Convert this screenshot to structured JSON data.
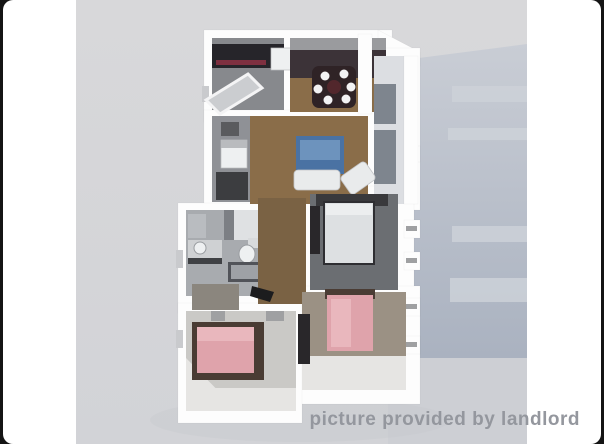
{
  "watermark": {
    "text": "picture provided by landlord"
  },
  "scene": {
    "description": "3D rendered top-down floor plan of a two-bedroom-plus-den apartment on a gray studio background"
  },
  "colors": {
    "frame_bg": "#141414",
    "card_bg": "#ffffff",
    "photo_top": "#d8d8da",
    "photo_bottom": "#d2d3d7",
    "shadow_top": "#c9cdd5",
    "shadow_bottom": "#aab2c0",
    "shadow_band": "#cdd1d8",
    "shadow_lower": "#cdcfd4",
    "wall": "#fdfdfd",
    "wall_shade": "#c9cacd",
    "wood": "#8a6d49",
    "wood_dark": "#7a6244",
    "dark_band": "#3c3338",
    "inner_wall_gray": "#9a9b9e",
    "kitchen_floor": "#87898d",
    "counter_dark": "#26252a",
    "counter_accent": "#7e3040",
    "appliance": "#eef0f1",
    "utility_floor": "#8f9196",
    "utility_dark": "#3c3d40",
    "tile": "#a8abaf",
    "fixture_light": "#cfd1d3",
    "fixture_dark": "#515359",
    "tub_inner": "#9ea1a6",
    "master_floor": "#6b6e72",
    "master_headboard": "#39393c",
    "bed_white": "#dde0e2",
    "bed_white_frame": "#2e2e32",
    "warm_floor": "#9b9184",
    "light_floor": "#cac9c6",
    "lit_floor": "#e6e5e3",
    "bed_pink": "#dfa3ab",
    "bed_pink_light": "#e9b7bd",
    "bed_frame": "#4a3c34",
    "closet_dark": "#29272a",
    "table_dark": "#2f2326",
    "table_center": "#52272c",
    "rug_blue": "#4a72a3",
    "rug_blue_light": "#6d93bd",
    "sofa": "#e9ebec",
    "dresser": "#8b867e",
    "door_mark": "#9fa0a2",
    "hall_door_dark": "#1c1c1e",
    "watermark": "#94979e"
  }
}
